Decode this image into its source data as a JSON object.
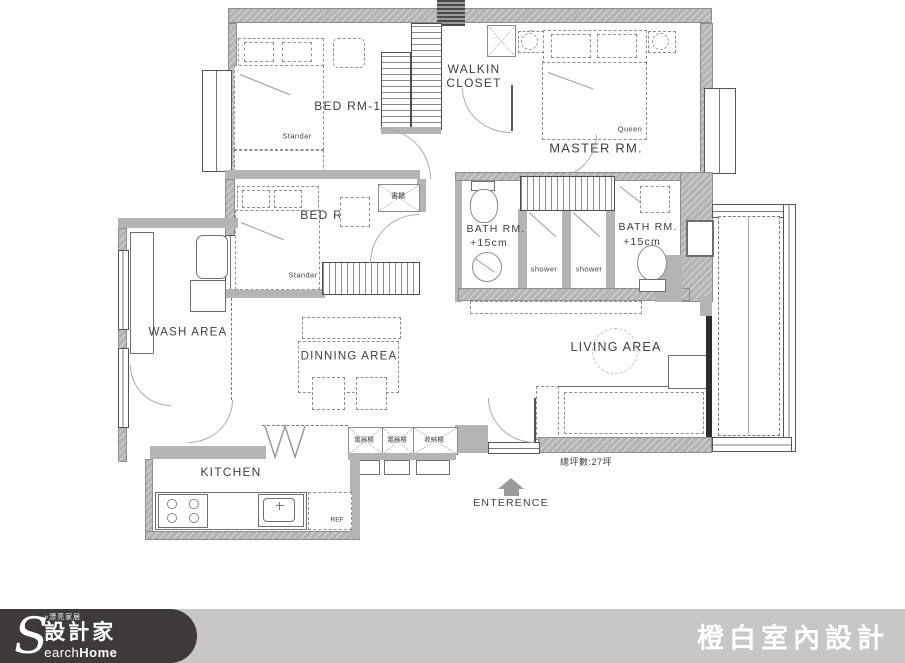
{
  "colors": {
    "wall": "#b4b4b4",
    "line": "#3f3f3f",
    "footer_bar": "#c7c7c7",
    "footer_logo_bg": "#3e3a3a"
  },
  "rooms": {
    "bed1": {
      "label": "BED RM-1.",
      "bed": "Standar"
    },
    "closet": {
      "line1": "WALKIN",
      "line2": "CLOSET"
    },
    "master": {
      "label": "MASTER RM.",
      "bed": "Queen"
    },
    "bed2": {
      "label": "BED RM-2.",
      "bed": "Standar",
      "cabinet": "書櫃"
    },
    "bath_left": {
      "label": "BATH RM.",
      "note": "+15cm"
    },
    "bath_right": {
      "label": "BATH RM.",
      "note": "+15cm"
    },
    "shower1": {
      "label": "shower"
    },
    "shower2": {
      "label": "shower"
    },
    "wash": {
      "label": "WASH AREA"
    },
    "dinning": {
      "label": "DINNING AREA"
    },
    "living": {
      "label": "LIVING AREA"
    },
    "kitchen": {
      "label": "KITCHEN",
      "fridge": "REF"
    }
  },
  "cabinets": [
    "電器櫃",
    "電器櫃",
    "收納櫃"
  ],
  "annotations": {
    "entrance": "ENTERENCE",
    "total_area": "總坪數:27坪"
  },
  "footer": {
    "tagline": "»漂亮家居",
    "brand_initial": "S",
    "brand_zh": "設計家",
    "brand_en_light": "earch",
    "brand_en_bold": "Home",
    "company": "橙白室內設計"
  }
}
